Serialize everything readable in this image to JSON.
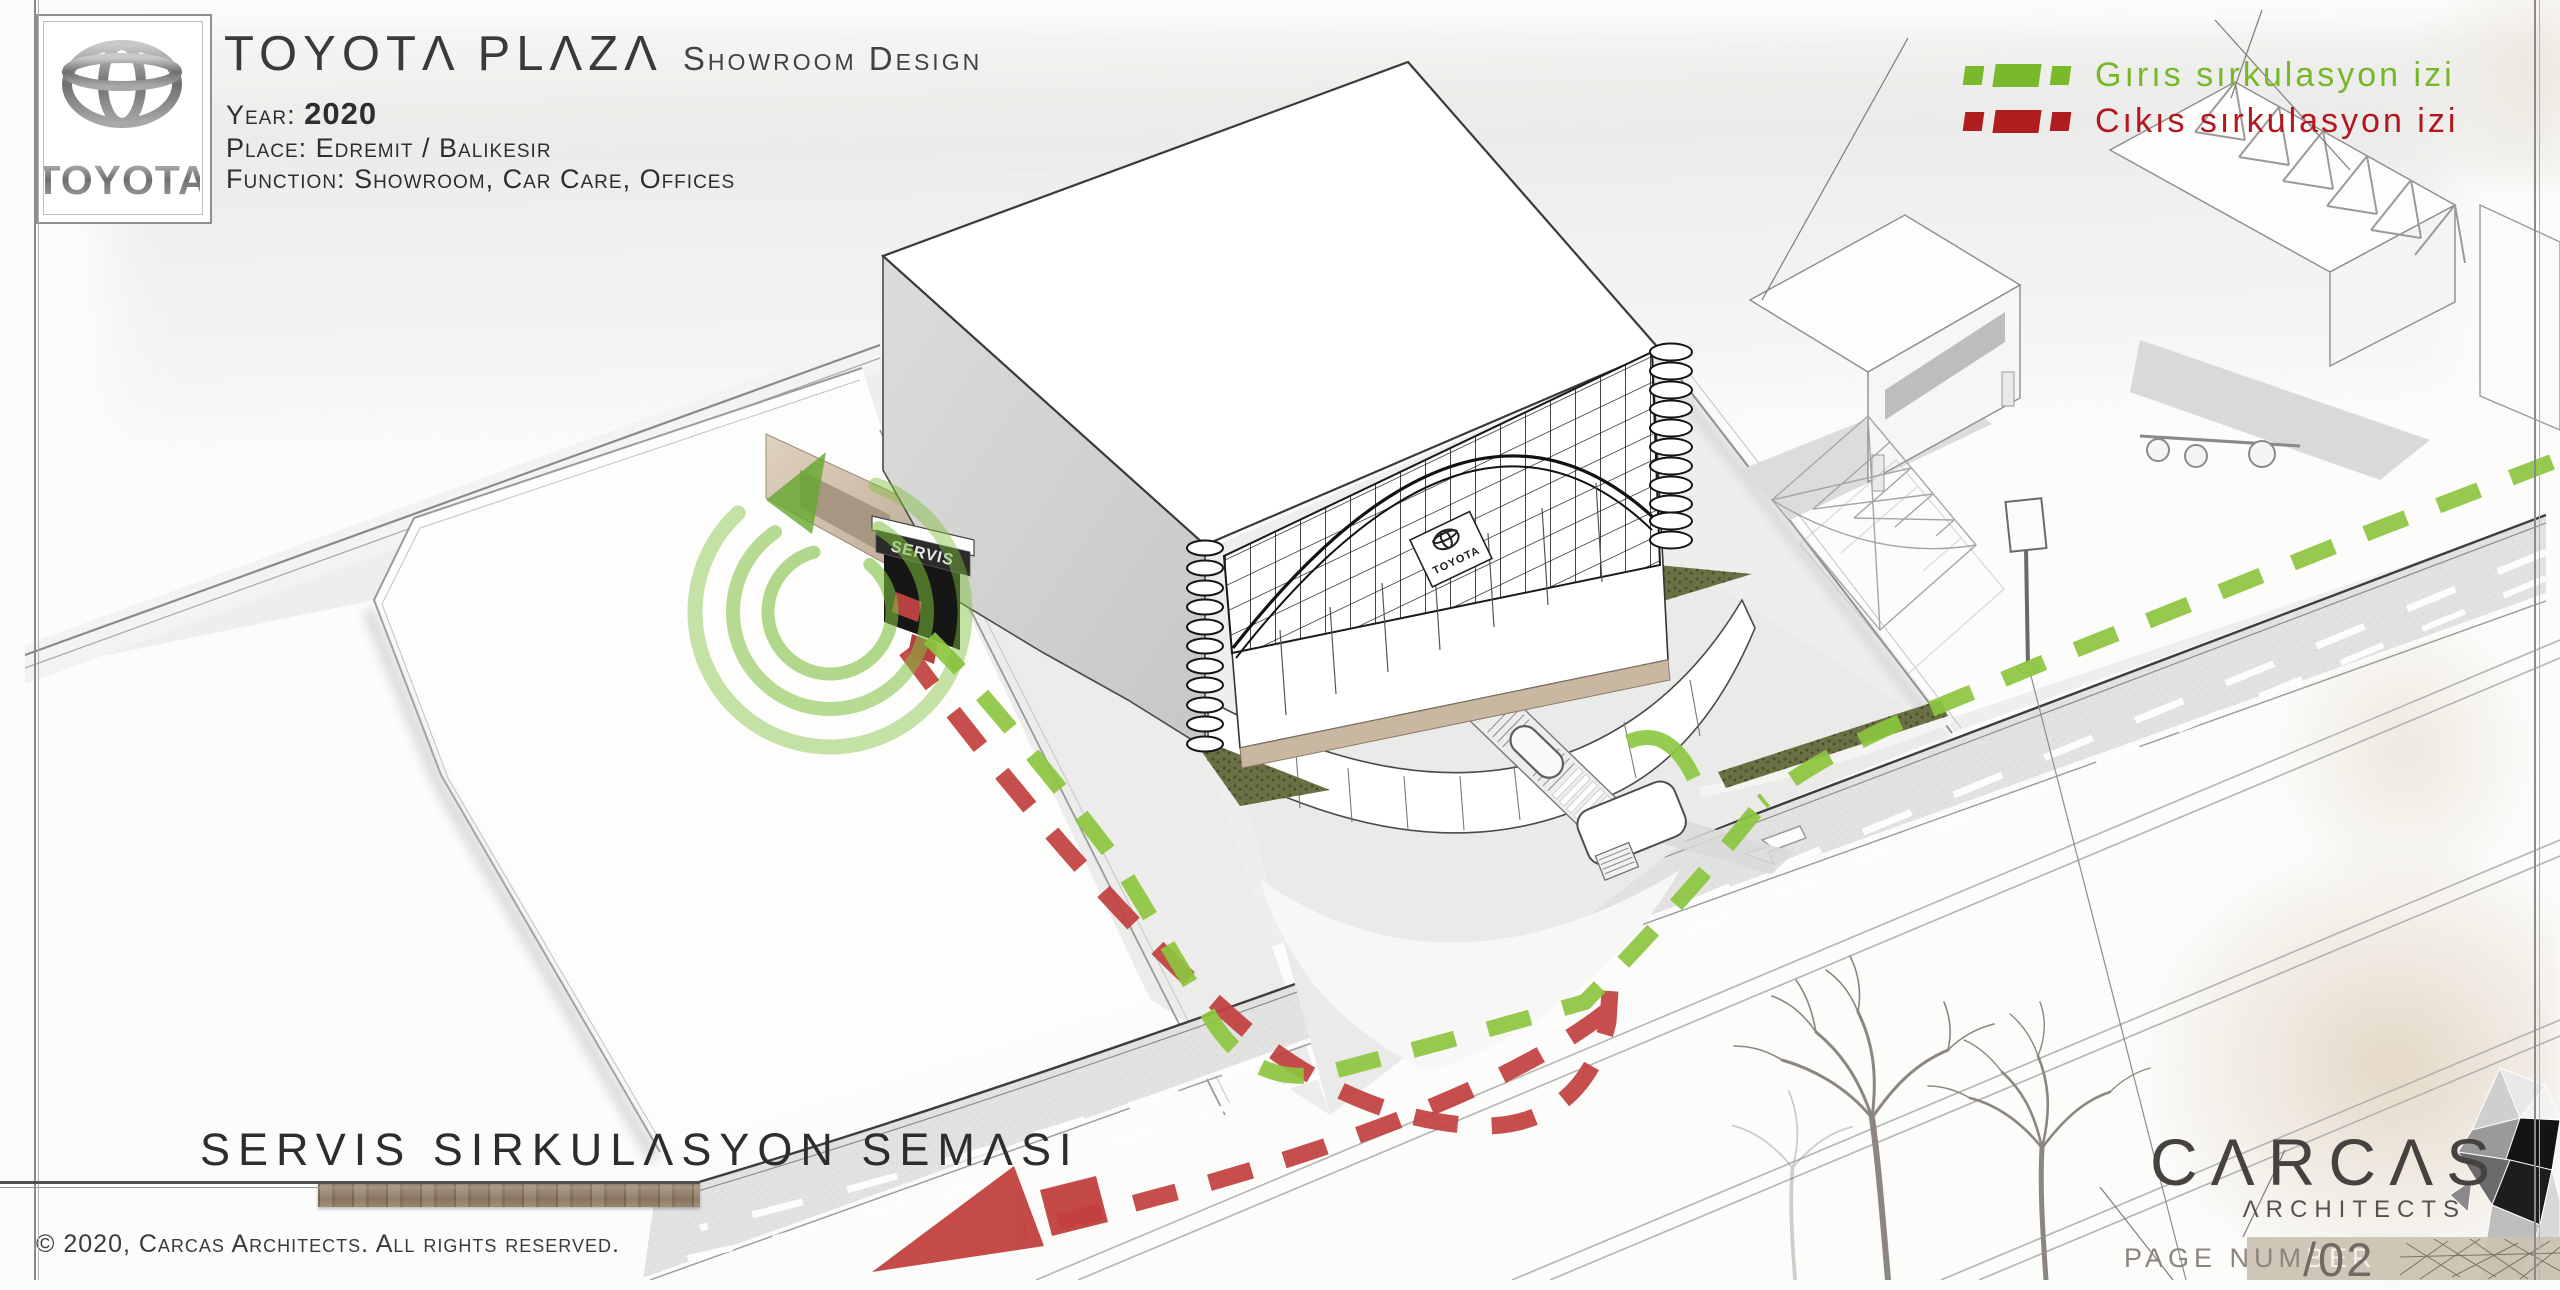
{
  "header": {
    "title_main": "TOYOTΛ PLΛZΛ",
    "title_sub": "Showroom Design",
    "year_label": "Year:",
    "year_value": "2020",
    "place_label": "Place:",
    "place_value": "Edremit / Balikesir",
    "function_label": "Function:",
    "function_value": "Showroom, Car Care, Offices",
    "logo_text": "TOYOTA"
  },
  "legend": {
    "items": [
      {
        "id": "entry",
        "label": "Gırıs sırkulasyon izi",
        "color": "#76b82a"
      },
      {
        "id": "exit",
        "label": "Cıkıs sırkulasyon izi",
        "color": "#b3161f"
      }
    ]
  },
  "drawing": {
    "servis_sign": "SERVIS",
    "facade_sign": "TOYOTA",
    "path_colors": {
      "entry": "#8cc63f",
      "exit": "#c2413f"
    },
    "accent_colors": {
      "hedge_olive": "#6b7044",
      "road_gray": "#e2e2e0",
      "ramp_tan": "#d2c0ab",
      "wood_bar": "#97836d",
      "page_bar_tan": "#ccc2b2"
    }
  },
  "footer": {
    "drawing_title": "SERVIS SIRKULΛSYON SEMΛSI",
    "copyright": "© 2020, Carcas Architects.  All rights reserved.",
    "firm_name": "CΛRCΛS",
    "firm_sub": "ΛRCHITECTS",
    "page_label_dark": "PAGE NUM",
    "page_label_light": "BER",
    "page_value": "/02"
  }
}
